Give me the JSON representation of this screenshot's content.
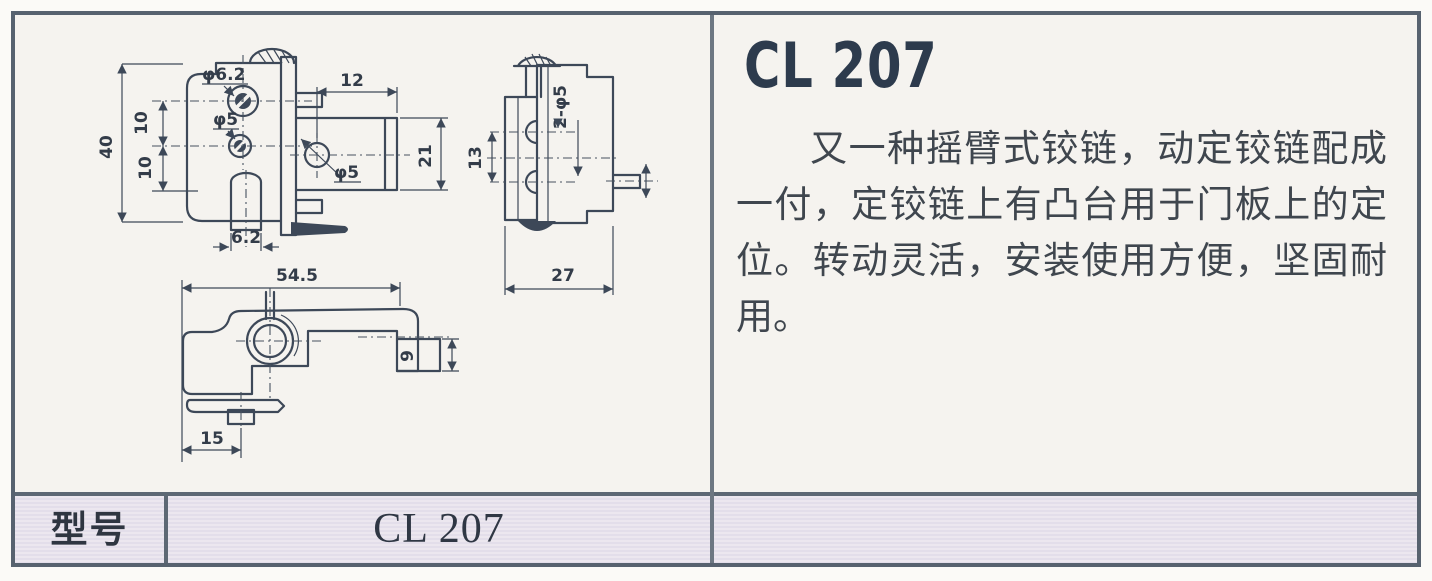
{
  "product": {
    "title": "CL 207",
    "description": "又一种摇臂式铰链，动定铰链配成一付，定铰链上有凸台用于门板上的定位。转动灵活，安装使用方便，坚固耐用。"
  },
  "spec_row": {
    "model_label": "型号",
    "model_value": "CL 207"
  },
  "drawings": {
    "front_view": {
      "overall_height": "40",
      "hole_pitch_upper": "10",
      "hole_pitch_lower": "10",
      "hole_dia_top": "φ6.2",
      "hole_dia_mid": "φ5",
      "arm_length": "12",
      "arm_height": "21",
      "arm_hole_dia": "φ5",
      "boss_width": "6.2"
    },
    "side_view": {
      "holes": "2-φ5",
      "hole_pitch": "13",
      "depth": "27"
    },
    "top_view": {
      "overall_length": "54.5",
      "tab_offset": "15",
      "foot_width": "9"
    }
  },
  "colors": {
    "border": "#57626f",
    "divider": "#6d7782",
    "drawing_line": "#3d4858",
    "title_text": "#2d3b4d",
    "body_text": "#3f464e",
    "spec_row_bg": "#e8e3ec",
    "panel_bg": "#f5f3ef"
  }
}
